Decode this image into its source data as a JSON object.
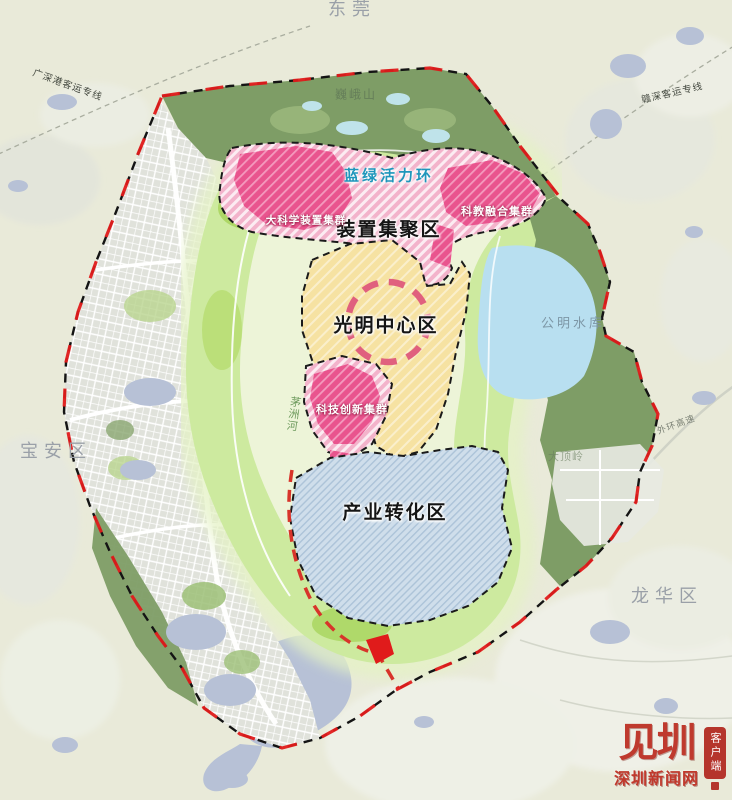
{
  "map": {
    "neighbors": {
      "dongguan": "东莞",
      "baoan": "宝安区",
      "longhua": "龙华区"
    },
    "natural": {
      "mountain": "巍峨山",
      "reservoir": "公明水库",
      "hill": "大顶岭",
      "river": "茅洲河"
    },
    "zones": {
      "vitality_ring": "蓝绿活力环",
      "device_zone": "装置集聚区",
      "big_science": "大科学装置集群",
      "sci_edu": "科教融合集群",
      "center": "光明中心区",
      "tech_innov": "科技创新集群",
      "industry": "产业转化区"
    },
    "transport": {
      "rail_nw": "广深港客运专线",
      "rail_ne": "赣深客运专线",
      "expressway": "外环高速"
    },
    "colors": {
      "boundary_red": "#e01b1b",
      "cluster_pink": "#e9548e",
      "zone_pink_light": "#f3b3cb",
      "center_yellow": "#f6e2a2",
      "industry_blue": "#cfdeeb",
      "ring_green": "#cdea9f",
      "forest_green": "#7e9d66",
      "water_blue": "#b8dff0",
      "ring_label_blue": "#1f96bb"
    }
  },
  "watermark": {
    "logo_text": "见圳",
    "site_name": "深圳新闻网",
    "client_label": "客户端"
  }
}
